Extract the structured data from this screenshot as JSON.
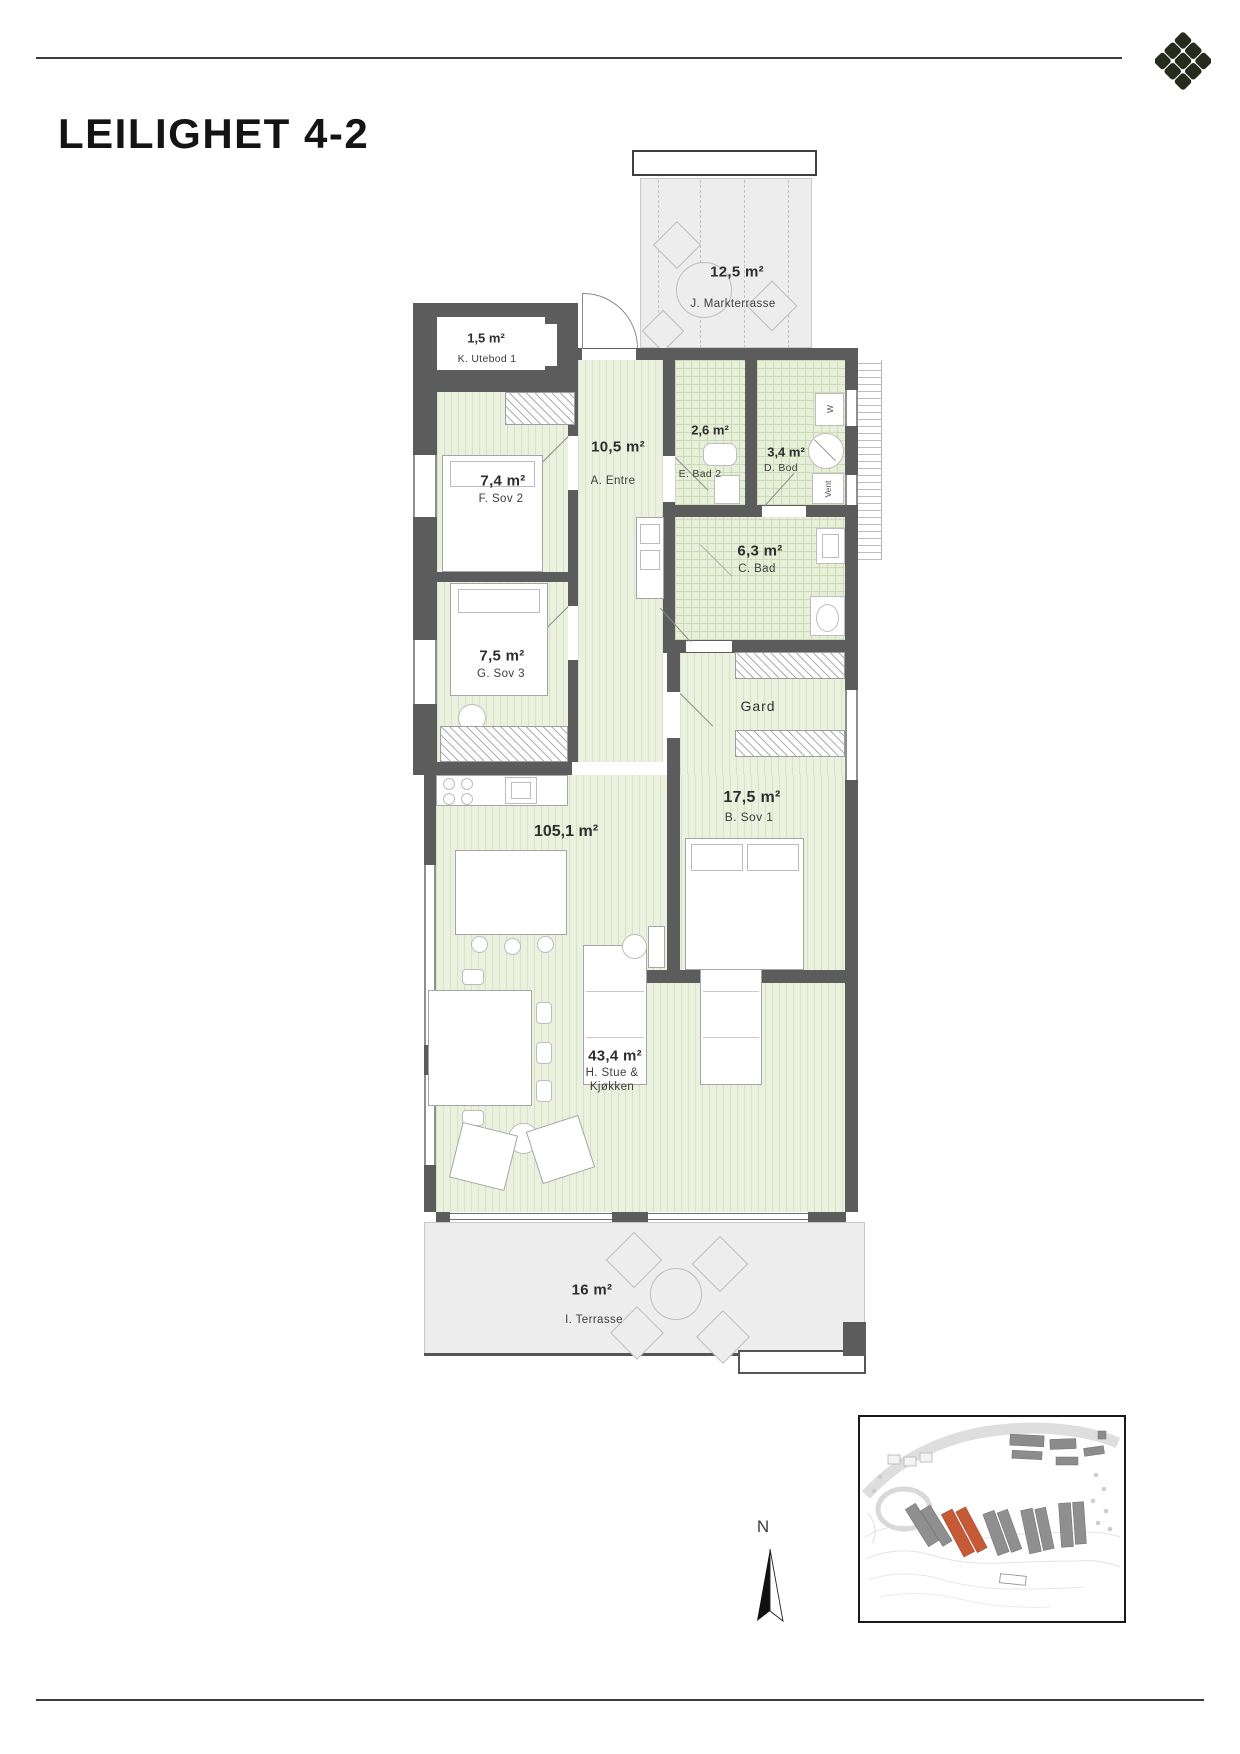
{
  "page": {
    "title": "LEILIGHET 4-2"
  },
  "plan": {
    "rooms": {
      "markterrasse": {
        "area": "12,5 m²",
        "name": "J. Markterrasse"
      },
      "utebod": {
        "area": "1,5 m²",
        "name": "K. Utebod 1"
      },
      "sov2": {
        "area": "7,4 m²",
        "name": "F. Sov 2"
      },
      "entre": {
        "area": "10,5 m²",
        "name": "A. Entre"
      },
      "bad2": {
        "area": "2,6 m²",
        "name": "E. Bad 2"
      },
      "bod": {
        "area": "3,4 m²",
        "name": "D. Bod"
      },
      "bad": {
        "area": "6,3 m²",
        "name": "C. Bad"
      },
      "sov3": {
        "area": "7,5 m²",
        "name": "G. Sov 3"
      },
      "sov1": {
        "area": "17,5 m²",
        "name": "B. Sov 1"
      },
      "stue": {
        "area": "43,4 m²",
        "name_line1": "H. Stue &",
        "name_line2": "Kjøkken"
      },
      "terrasse": {
        "area": "16 m²",
        "name": "I. Terrasse"
      },
      "gard": {
        "label": "Gard"
      },
      "total_area": "105,1 m²"
    },
    "appliances": {
      "washer": "W",
      "vent": "Vent"
    },
    "compass": {
      "north": "N"
    }
  },
  "icons": {
    "logo": "diamond-rosette-icon",
    "north_arrow": "north-arrow-icon"
  },
  "colors": {
    "wall": "#5c5c5c",
    "floor_wood": "#ecf1df",
    "floor_tile": "#e7efd8",
    "terrace": "#ededed",
    "highlight_building": "#c75a36"
  }
}
